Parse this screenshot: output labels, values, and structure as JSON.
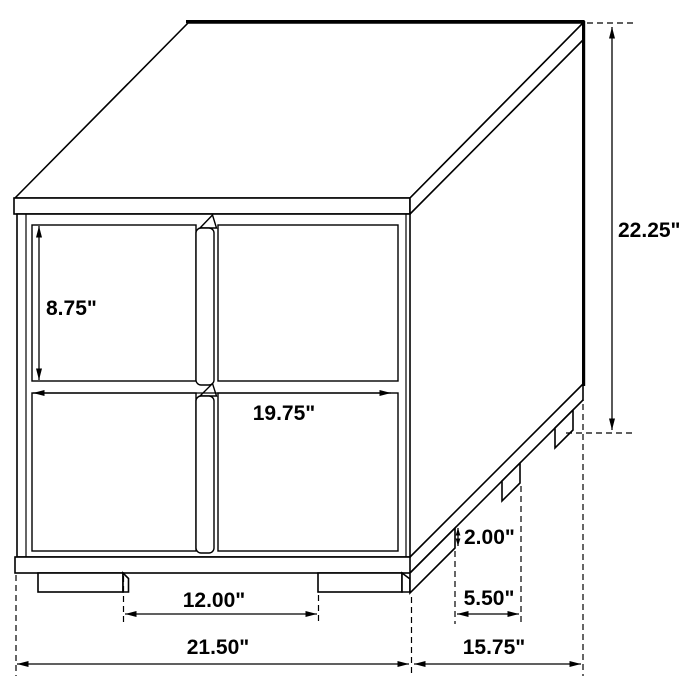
{
  "page": {
    "background": "#ffffff",
    "line_color": "#000000"
  },
  "diagram": {
    "description": "Isometric technical line drawing of a two-drawer nightstand / end table with dimension annotations",
    "dimensions": {
      "drawer_height": "8.75\"",
      "overall_height": "22.25\"",
      "drawer_width": "19.75\"",
      "front_leg_spacing": "12.00\"",
      "overall_width": "21.50\"",
      "side_leg_spacing": "5.50\"",
      "overall_depth": "15.75\"",
      "leg_height": "2.00\""
    }
  }
}
